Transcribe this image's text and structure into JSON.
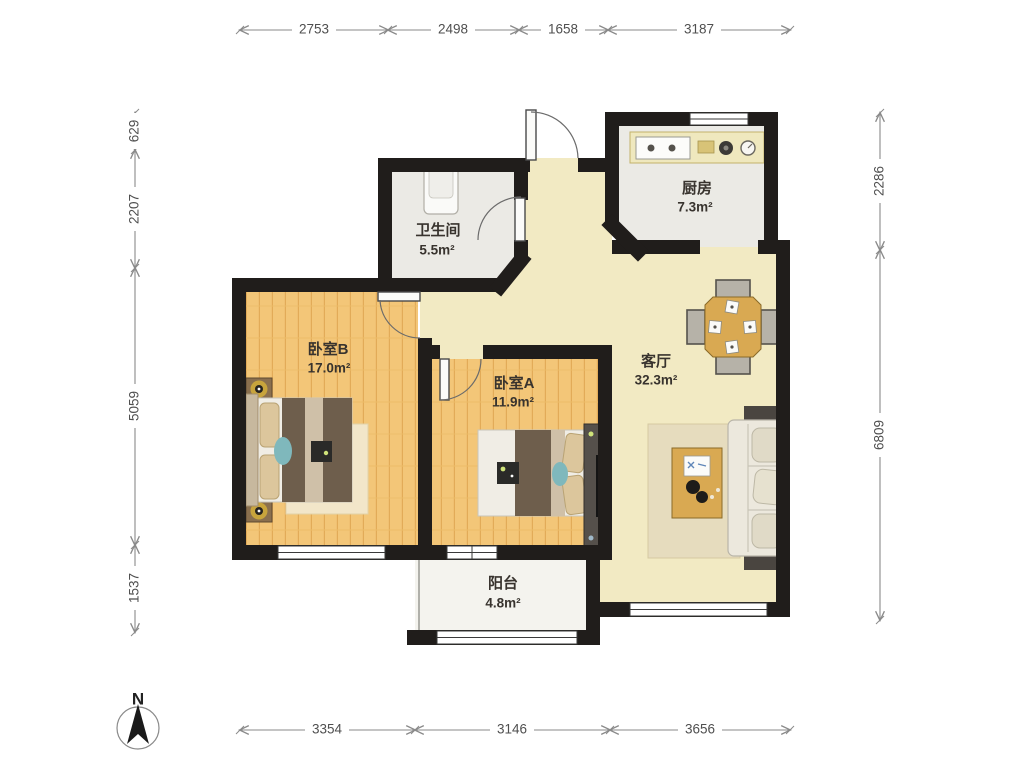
{
  "plan": {
    "title": "two-bedroom apartment floor plan",
    "compass": {
      "label": "N"
    },
    "rooms": {
      "bathroom": {
        "name": "卫生间",
        "area": "5.5m²"
      },
      "kitchen": {
        "name": "厨房",
        "area": "7.3m²"
      },
      "bedroom_b": {
        "name": "卧室B",
        "area": "17.0m²"
      },
      "bedroom_a": {
        "name": "卧室A",
        "area": "11.9m²"
      },
      "living": {
        "name": "客厅",
        "area": "32.3m²"
      },
      "balcony": {
        "name": "阳台",
        "area": "4.8m²"
      }
    },
    "dims": {
      "top": [
        "2753",
        "2498",
        "1658",
        "3187"
      ],
      "left": [
        "629",
        "2207",
        "5059",
        "1537"
      ],
      "right": [
        "2286",
        "6809"
      ],
      "bottom": [
        "3354",
        "3146",
        "3656"
      ]
    },
    "colors": {
      "wall": "#201d1b",
      "wood_floor": "#f3c678",
      "living_floor": "#f2eac3",
      "service_floor": "#ebeae5",
      "dimension_text": "#4f4f4f"
    }
  }
}
